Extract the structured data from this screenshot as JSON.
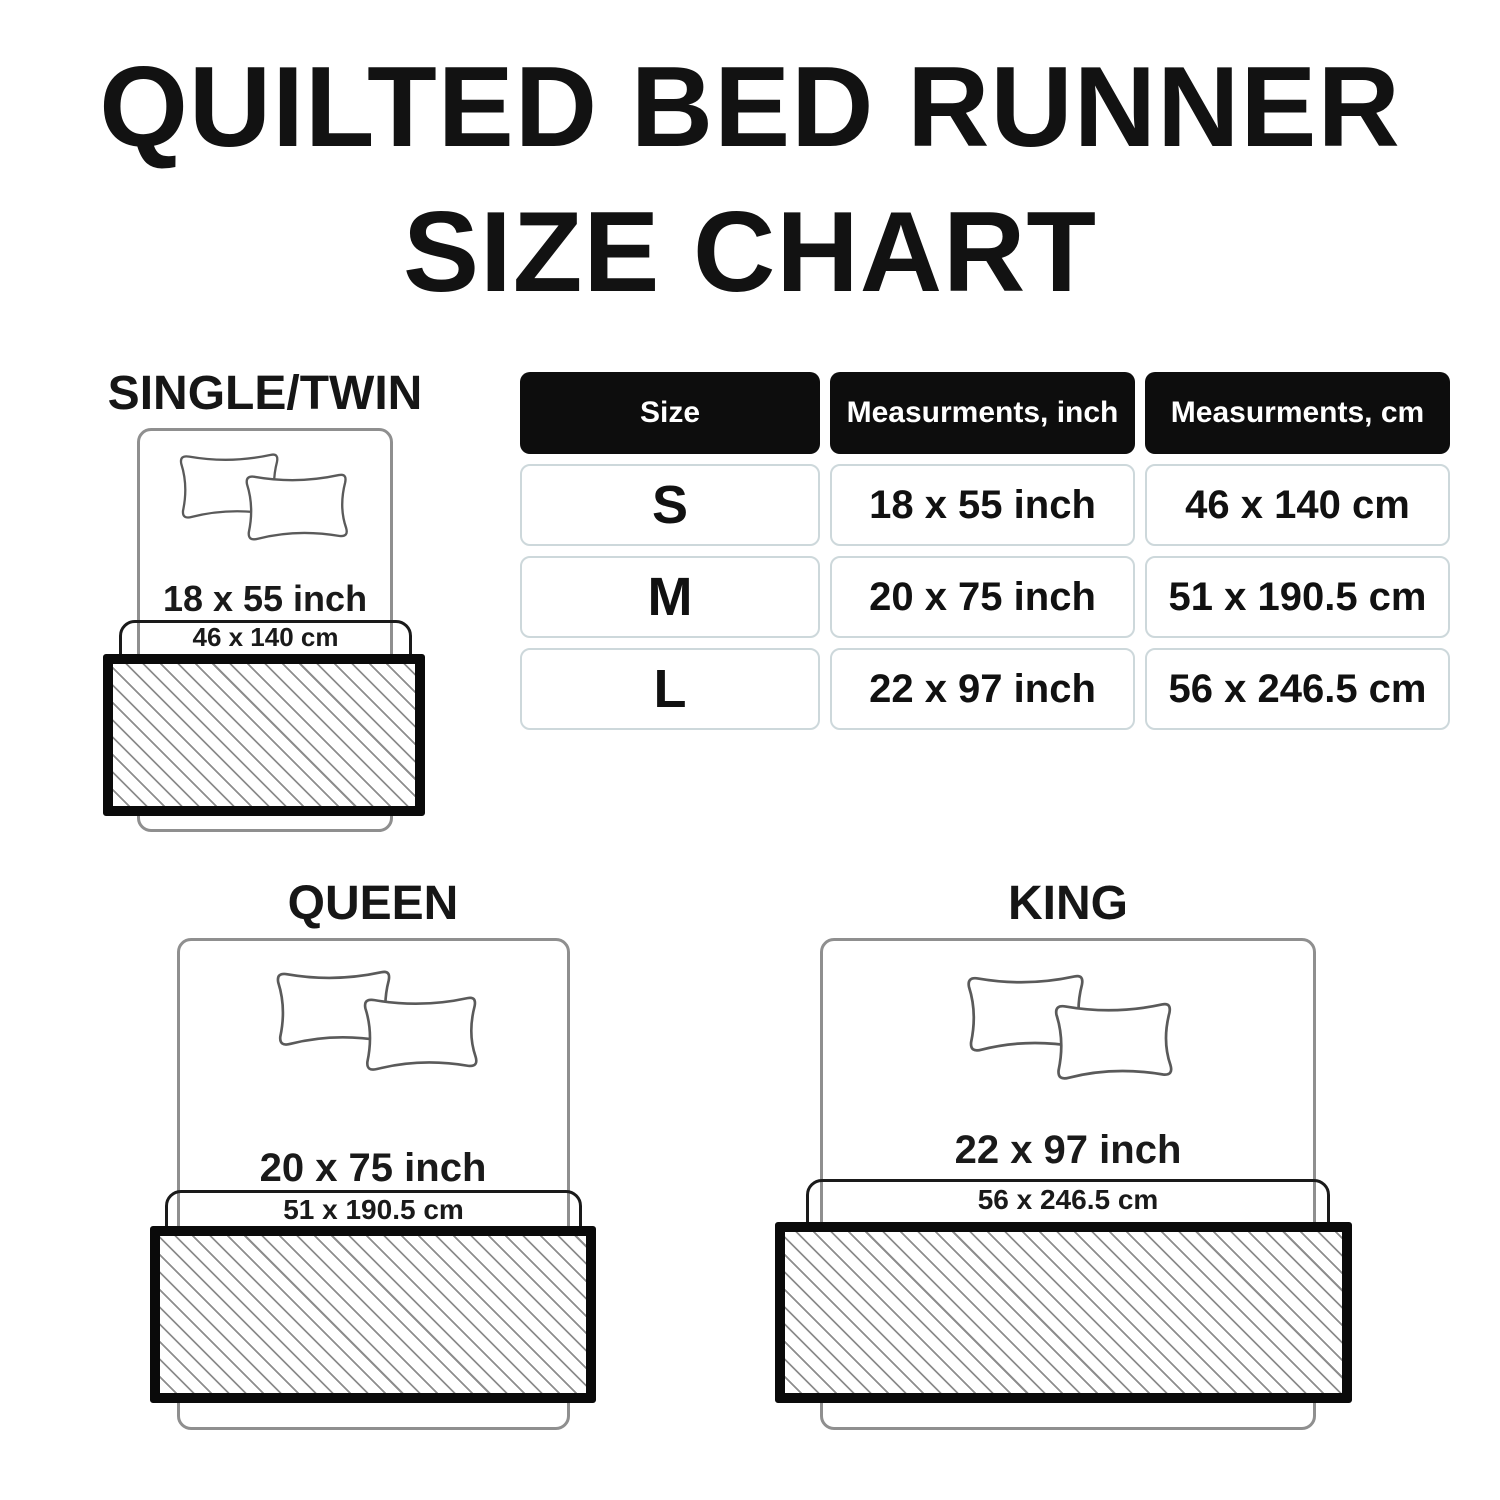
{
  "title": {
    "line1": "QUILTED BED RUNNER",
    "line2": "SIZE CHART"
  },
  "table": {
    "headers": [
      "Size",
      "Measurments, inch",
      "Measurments, cm"
    ],
    "rows": [
      {
        "size": "S",
        "inch": "18 x 55 inch",
        "cm": "46 x 140 cm"
      },
      {
        "size": "M",
        "inch": "20 x 75 inch",
        "cm": "51 x 190.5 cm"
      },
      {
        "size": "L",
        "inch": "22 x 97 inch",
        "cm": "56 x 246.5 cm"
      }
    ]
  },
  "diagrams": {
    "single": {
      "label": "SINGLE/TWIN",
      "inch": "18 x 55 inch",
      "cm": "46 x 140 cm"
    },
    "queen": {
      "label": "QUEEN",
      "inch": "20 x 75 inch",
      "cm": "51 x 190.5 cm"
    },
    "king": {
      "label": "KING",
      "inch": "22 x 97 inch",
      "cm": "56 x 246.5 cm"
    }
  },
  "colors": {
    "text": "#111111",
    "table_header_bg": "#0d0d0d",
    "table_header_text": "#ffffff",
    "table_cell_border": "#cdd8db",
    "bed_outline": "#8f8f8f",
    "pillow_outline": "#5a5a5a",
    "runner_frame": "#0a0a0a",
    "hatch_line": "#8d8d8d"
  }
}
